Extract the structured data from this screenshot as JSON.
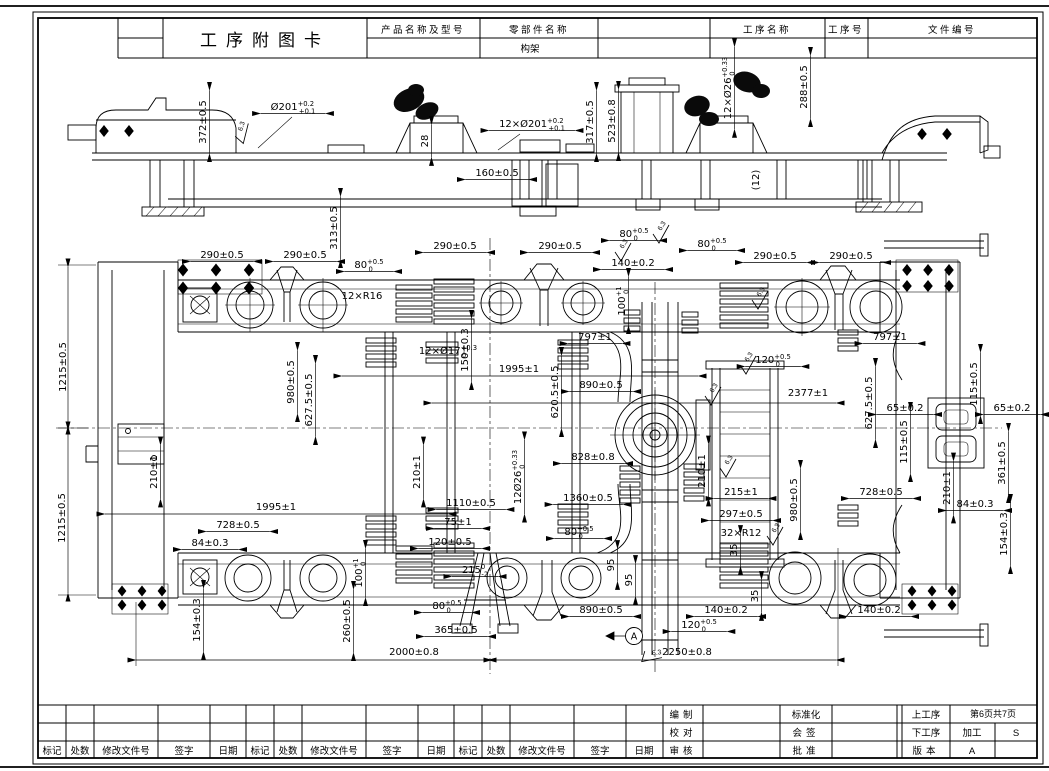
{
  "header": {
    "title": "工序附图卡",
    "product_label": "产品名称及型号",
    "part_label": "零部件名称",
    "part_value": "构架",
    "process_label": "工序名称",
    "process_no_label": "工序号",
    "doc_no_label": "文件编号"
  },
  "footer": {
    "rev": [
      "标记",
      "处数",
      "修改文件号",
      "签字",
      "日期"
    ],
    "bianzhi": "编制",
    "jiaodui": "校对",
    "shenhe": "审核",
    "biaozhunhua": "标准化",
    "huiqian": "会签",
    "pizhun": "批准",
    "shanggongxu": "上工序",
    "xiagongxu": "下工序",
    "banben": "版本",
    "jiagong": "加工",
    "version_value": "A",
    "page": "第6页共7页",
    "s_value": "S"
  },
  "drawing": {
    "annotations": [
      {
        "t": "372±0.5",
        "x": 206,
        "y": 122,
        "rot": -90
      },
      {
        "t": "Ø201",
        "sup": "+0.2",
        "sub": "+0.1",
        "x": 293,
        "y": 110
      },
      {
        "t": "12×Ø201",
        "sup": "+0.2",
        "sub": "+0.1",
        "x": 532,
        "y": 127
      },
      {
        "t": "28",
        "x": 428,
        "y": 141,
        "rot": -90
      },
      {
        "t": "160±0.5",
        "x": 497,
        "y": 176
      },
      {
        "t": "317±0.5",
        "x": 593,
        "y": 122,
        "rot": -90
      },
      {
        "t": "523±0.8",
        "x": 615,
        "y": 121,
        "rot": -90
      },
      {
        "t": "12×Ø26",
        "sup": "+0.33",
        "sub": "0",
        "x": 731,
        "y": 88,
        "rot": -90
      },
      {
        "t": "288±0.5",
        "x": 807,
        "y": 87,
        "rot": -90
      },
      {
        "t": "(12)",
        "x": 759,
        "y": 180,
        "rot": -90,
        "nl": 1
      },
      {
        "t": "313±0.5",
        "x": 337,
        "y": 228,
        "rot": -90
      },
      {
        "t": "290±0.5",
        "x": 222,
        "y": 258
      },
      {
        "t": "290±0.5",
        "x": 305,
        "y": 258
      },
      {
        "t": "80",
        "sup": "+0.5",
        "sub": "0",
        "x": 369,
        "y": 268
      },
      {
        "t": "12×R16",
        "x": 362,
        "y": 299,
        "nl": 1
      },
      {
        "t": "290±0.5",
        "x": 455,
        "y": 249
      },
      {
        "t": "290±0.5",
        "x": 560,
        "y": 249
      },
      {
        "t": "80",
        "sup": "+0.5",
        "sub": "0",
        "x": 634,
        "y": 237
      },
      {
        "t": "140±0.2",
        "x": 633,
        "y": 266
      },
      {
        "t": "80",
        "sup": "+0.5",
        "sub": "0",
        "x": 712,
        "y": 247
      },
      {
        "t": "290±0.5",
        "x": 775,
        "y": 259
      },
      {
        "t": "290±0.5",
        "x": 851,
        "y": 259
      },
      {
        "t": "100",
        "sup": "+1",
        "sub": "0",
        "x": 625,
        "y": 301,
        "rot": -90
      },
      {
        "t": "1215±0.5",
        "x": 66,
        "y": 367,
        "rot": -90,
        "nl": 1
      },
      {
        "t": "12×Ø17",
        "sup": "+0.3",
        "sub": "0",
        "x": 448,
        "y": 354,
        "nl": 1
      },
      {
        "t": "150±0.3",
        "x": 468,
        "y": 350,
        "rot": -90
      },
      {
        "t": "797±1",
        "x": 595,
        "y": 340
      },
      {
        "t": "1995±1",
        "x": 519,
        "y": 372,
        "nl": 1
      },
      {
        "t": "890±0.5",
        "x": 601,
        "y": 388
      },
      {
        "t": "620.5±0.5",
        "x": 558,
        "y": 392,
        "rot": -90
      },
      {
        "t": "980±0.5",
        "x": 294,
        "y": 382,
        "rot": -90
      },
      {
        "t": "627.5±0.5",
        "x": 312,
        "y": 400,
        "rot": -90
      },
      {
        "t": "120",
        "sup": "+0.5",
        "sub": "0",
        "x": 773,
        "y": 363
      },
      {
        "t": "2377±1",
        "x": 808,
        "y": 396,
        "nl": 1
      },
      {
        "t": "797±1",
        "x": 890,
        "y": 340
      },
      {
        "t": "627.5±0.5",
        "x": 872,
        "y": 403,
        "rot": -90
      },
      {
        "t": "115±0.5",
        "x": 977,
        "y": 384,
        "rot": -90
      },
      {
        "t": "65±0.2",
        "x": 905,
        "y": 411
      },
      {
        "t": "65±0.2",
        "x": 1012,
        "y": 411
      },
      {
        "t": "115±0.5",
        "x": 907,
        "y": 442,
        "rot": -90
      },
      {
        "t": "361±0.5",
        "x": 1005,
        "y": 463,
        "rot": -90
      },
      {
        "t": "210±1",
        "x": 157,
        "y": 472,
        "rot": -90
      },
      {
        "t": "210±1",
        "x": 420,
        "y": 472,
        "rot": -90
      },
      {
        "t": "12Ø26",
        "sup": "+0.33",
        "sub": "0",
        "x": 521,
        "y": 477,
        "rot": -90
      },
      {
        "t": "828±0.8",
        "x": 593,
        "y": 460
      },
      {
        "t": "210±1",
        "x": 705,
        "y": 471,
        "rot": -90
      },
      {
        "t": "215±1",
        "x": 741,
        "y": 495
      },
      {
        "t": "210±1",
        "x": 950,
        "y": 488,
        "rot": -90
      },
      {
        "t": "1360±0.5",
        "x": 588,
        "y": 501
      },
      {
        "t": "1110±0.5",
        "x": 471,
        "y": 506
      },
      {
        "t": "297±0.5",
        "x": 741,
        "y": 517
      },
      {
        "t": "980±0.5",
        "x": 797,
        "y": 500,
        "rot": -90
      },
      {
        "t": "728±0.5",
        "x": 881,
        "y": 495
      },
      {
        "t": "32×R12",
        "x": 741,
        "y": 536,
        "nl": 1
      },
      {
        "t": "84±0.3",
        "x": 975,
        "y": 507
      },
      {
        "t": "154±0.3",
        "x": 1007,
        "y": 534,
        "rot": -90
      },
      {
        "t": "1215±0.5",
        "x": 65,
        "y": 518,
        "rot": -90,
        "nl": 1
      },
      {
        "t": "1995±1",
        "x": 276,
        "y": 510,
        "nl": 1
      },
      {
        "t": "728±0.5",
        "x": 238,
        "y": 528
      },
      {
        "t": "84±0.3",
        "x": 210,
        "y": 546
      },
      {
        "t": "75±1",
        "x": 458,
        "y": 525
      },
      {
        "t": "120±0.5",
        "x": 450,
        "y": 545
      },
      {
        "t": "80",
        "sup": "+0.5",
        "sub": "0",
        "x": 579,
        "y": 535
      },
      {
        "t": "215",
        "sup": "0",
        "sub": "-2",
        "x": 475,
        "y": 573
      },
      {
        "t": "95",
        "x": 614,
        "y": 565,
        "rot": -90
      },
      {
        "t": "95",
        "x": 632,
        "y": 580,
        "rot": -90
      },
      {
        "t": "35",
        "x": 737,
        "y": 550,
        "rot": -90
      },
      {
        "t": "35",
        "x": 758,
        "y": 596,
        "rot": -90
      },
      {
        "t": "154±0.3",
        "x": 200,
        "y": 620,
        "rot": -90
      },
      {
        "t": "100",
        "sup": "+1",
        "sub": "0",
        "x": 362,
        "y": 573,
        "rot": -90
      },
      {
        "t": "260±0.5",
        "x": 350,
        "y": 621,
        "rot": -90
      },
      {
        "t": "80",
        "sup": "+0.5",
        "sub": "0",
        "x": 447,
        "y": 609
      },
      {
        "t": "365±0.5",
        "x": 456,
        "y": 633
      },
      {
        "t": "890±0.5",
        "x": 601,
        "y": 613
      },
      {
        "t": "140±0.2",
        "x": 726,
        "y": 613
      },
      {
        "t": "120",
        "sup": "+0.5",
        "sub": "0",
        "x": 699,
        "y": 628
      },
      {
        "t": "140±0.2",
        "x": 879,
        "y": 613
      },
      {
        "t": "2000±0.8",
        "x": 414,
        "y": 655,
        "nl": 1
      },
      {
        "t": "2250±0.8",
        "x": 687,
        "y": 655,
        "nl": 1
      }
    ],
    "fcf": [
      {
        "sym": "⊥",
        "val": "0.2",
        "datum": "A",
        "x": 390,
        "y": 258
      },
      {
        "sym": "⊥",
        "val": "0.2",
        "datum": "A",
        "x": 483,
        "y": 342
      },
      {
        "sym": "//",
        "val": "0.2",
        "datum": "A",
        "x": 791,
        "y": 368
      },
      {
        "sym": "//",
        "val": "0.3",
        "datum": "A",
        "x": 723,
        "y": 411
      },
      {
        "sym": "//",
        "val": "0.2",
        "datum": "A",
        "x": 732,
        "y": 643
      }
    ],
    "datum": {
      "label": "A",
      "x": 634,
      "y": 636
    },
    "roughness": {
      "value": "6.3",
      "marks": [
        {
          "x": 240,
          "y": 135,
          "r": -15
        },
        {
          "x": 620,
          "y": 252,
          "r": 0
        },
        {
          "x": 658,
          "y": 234,
          "r": 0
        },
        {
          "x": 757,
          "y": 300,
          "r": 0
        },
        {
          "x": 745,
          "y": 365,
          "r": 0
        },
        {
          "x": 710,
          "y": 396,
          "r": 0
        },
        {
          "x": 725,
          "y": 468,
          "r": 0
        },
        {
          "x": 772,
          "y": 536,
          "r": 0
        },
        {
          "x": 648,
          "y": 655,
          "r": 50
        }
      ]
    }
  }
}
